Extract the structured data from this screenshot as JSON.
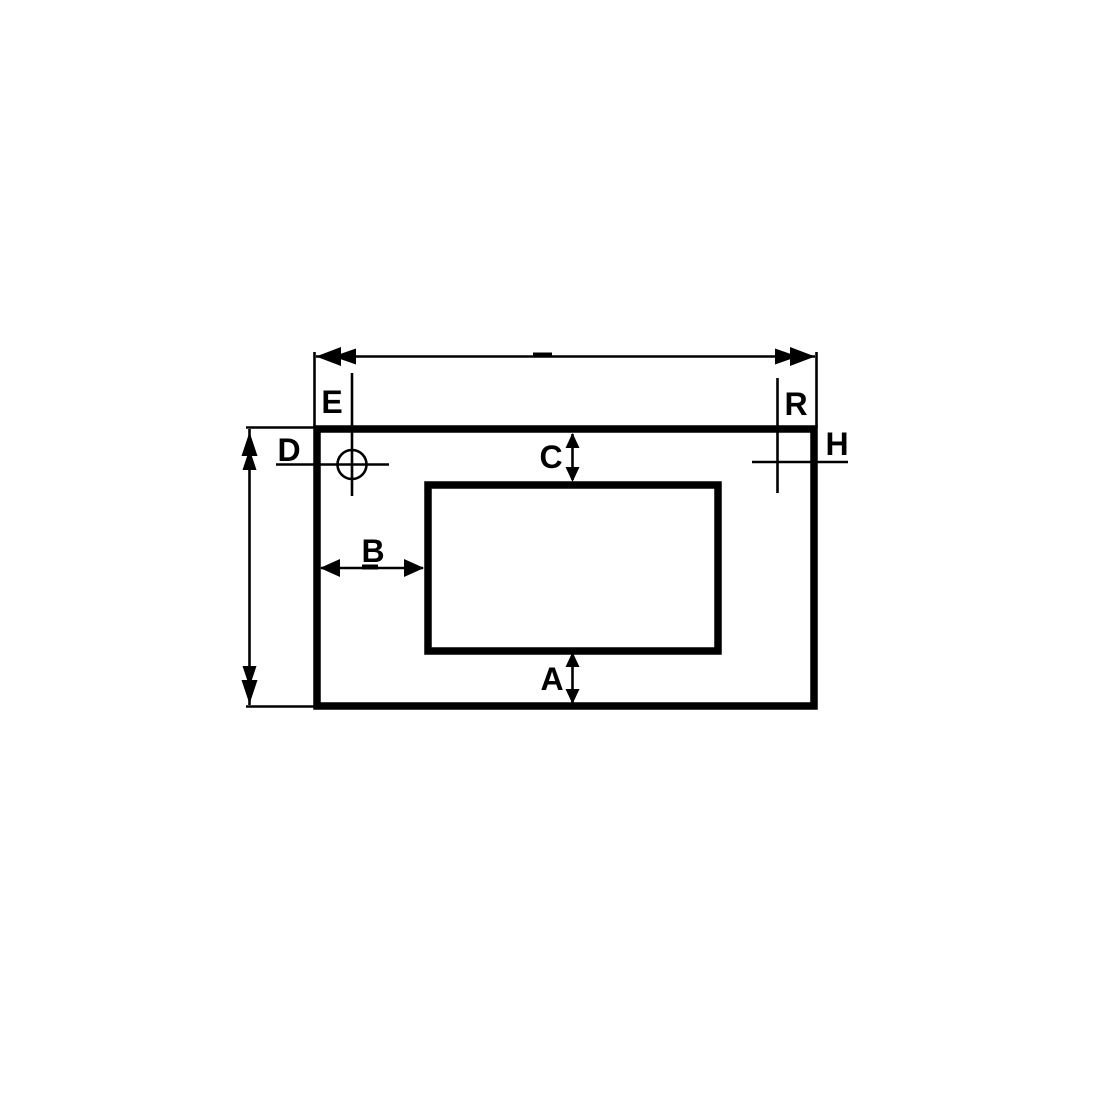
{
  "diagram": {
    "kind": "technical-dimension-drawing",
    "colors": {
      "line": "#000000",
      "background": "#ffffff"
    }
  },
  "labels": {
    "dim_e": "E",
    "dim_r": "R",
    "dim_d": "D",
    "dim_h": "H",
    "dim_c": "C",
    "dim_b": "B",
    "dim_a": "A"
  }
}
